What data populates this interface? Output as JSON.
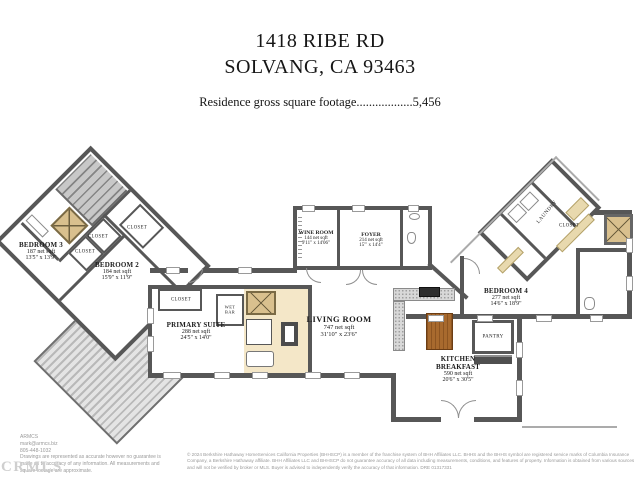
{
  "header": {
    "address_line1": "1418 RIBE RD",
    "address_line2": "SOLVANG, CA 93463",
    "footage_line": "Residence gross square footage..................5,456"
  },
  "rooms": {
    "bedroom3": {
      "name": "BEDROOM 3",
      "sqft": "187 net sqft",
      "dims": "13'5\" x 13'9\""
    },
    "bedroom2": {
      "name": "BEDROOM 2",
      "sqft": "184 net sqft",
      "dims": "15'9\" x 11'9\""
    },
    "primary_suite": {
      "name": "PRIMARY SUITE",
      "sqft": "288 net sqft",
      "dims": "24'5\" x 14'0\""
    },
    "wine_room": {
      "name": "WINE ROOM",
      "sqft": "144 net sqft",
      "dims": "9'11\" x 14'06\""
    },
    "foyer": {
      "name": "FOYER",
      "sqft": "214 net sqft",
      "dims": "15'\" x 14'4\""
    },
    "living_room": {
      "name": "LIVING ROOM",
      "sqft": "747 net sqft",
      "dims": "31'10\" x 23'6\""
    },
    "kitchen_breakfast": {
      "name_line1": "KITCHEN",
      "name_line2": "BREAKFAST",
      "sqft": "590 net sqft",
      "dims": "20'6\" x 30'5\""
    },
    "bedroom4": {
      "name": "BEDROOM 4",
      "sqft": "277 net sqft",
      "dims": "14'6\" x 18'9\""
    }
  },
  "labels": {
    "closet": "CLOSET",
    "laundry": "LAUNDRY",
    "pantry": "PANTRY",
    "wet_bar": "WET BAR"
  },
  "footer": {
    "preparer_name": "ARMCS",
    "preparer_email": "mark@armcs.biz",
    "preparer_phone": "805-448-1032",
    "preparer_disclaimer": "Drawings are represented as accurate however no guarantee is made as to accuracy of any information. All measurements and square footage are approximate.",
    "brokerage_disclaimer": "© 2024 Berkshire Hathaway HomeServices California Properties (BHHSCP) is a member of the franchise system of BHH Affiliates LLC. BHHS and the BHHS symbol are registered service marks of Columbia Insurance Company, a Berkshire Hathaway affiliate. BHH Affiliates LLC and BHHSCP do not guarantee accuracy of all data including measurements, conditions, and features of property. Information is obtained from various sources and will not be verified by broker or MLS. Buyer is advised to independently verify the accuracy of that information. DRE 01317331",
    "watermark": "CRMLS"
  },
  "colors": {
    "wall": "#575757",
    "bath_floor": "#f4e7c8",
    "shower_tan": "#d9c08e",
    "island_wood": "#a86a2e",
    "counter_granite": "#d8d8d8",
    "deck_stripe": "#b9b9b9"
  }
}
